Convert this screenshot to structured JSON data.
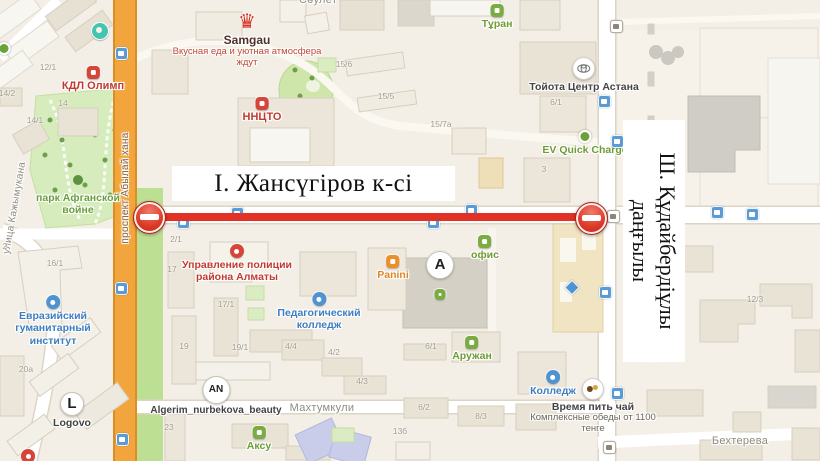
{
  "titles": {
    "horizontal": "І. Жансүгіров к-сі",
    "vertical_line1": "Ш. Құдайбердіұлы",
    "vertical_line2": "даңғылы"
  },
  "colors": {
    "map_bg": "#f3efe7",
    "road_orange": "#f3a53d",
    "park_green": "#d6ecbc",
    "strip_green": "#bcdf93",
    "closure_red": "#e23125",
    "poi_red": "#c13a30",
    "poi_green": "#6d9c33",
    "poi_blue": "#3d7dc0",
    "poi_orange": "#e08427",
    "street_gray": "#8f8b80"
  },
  "labels": [
    {
      "name": "poi-samgau",
      "type": "poi",
      "icon": "crown",
      "icon_size": 20,
      "x": 247,
      "y": 12,
      "text": "Samgau",
      "color": "#503028",
      "size": 12,
      "interactable": true
    },
    {
      "name": "samgau-tagline",
      "type": "tagline",
      "x": 247,
      "y": 46,
      "lines": [
        "Вкусная еда и уютная атмосфера",
        "ждут"
      ],
      "color": "#bf4936",
      "size": 9.5
    },
    {
      "name": "poi-kdl-olimp",
      "type": "poi",
      "icon": "red",
      "x": 93,
      "y": 66,
      "text": "КДЛ Олимп",
      "color": "#c13a30",
      "size": 11,
      "interactable": true
    },
    {
      "name": "poi-nncto",
      "type": "poi",
      "icon": "red",
      "x": 262,
      "y": 97,
      "text": "ННЦТО",
      "color": "#c13a30",
      "size": 11,
      "interactable": true
    },
    {
      "name": "poi-turan",
      "type": "poi",
      "icon": "green",
      "x": 497,
      "y": 4,
      "text": "Тұран",
      "color": "#6d9c33",
      "interactable": true
    },
    {
      "name": "poi-toyota-center",
      "type": "poi",
      "icon": "toyota",
      "icon_size": 21,
      "x": 584,
      "y": 57,
      "text": "Тойота Центр Астана",
      "color": "#454545",
      "interactable": true
    },
    {
      "name": "poi-ev-quick-charge",
      "type": "poi",
      "icon": "ev",
      "x": 585,
      "y": 130,
      "text": "EV Quick Charge",
      "color": "#6d9c33",
      "interactable": true
    },
    {
      "name": "poi-police-department",
      "type": "poi",
      "icon": "redround",
      "x": 237,
      "y": 244,
      "lines": [
        "Управление полиции",
        "района Алматы"
      ],
      "color": "#c13a30",
      "interactable": true
    },
    {
      "name": "poi-eurasian-institute",
      "type": "poi",
      "icon": "blue",
      "x": 53,
      "y": 295,
      "lines": [
        "Евразийский",
        "гуманитарный",
        "институт"
      ],
      "color": "#3d7dc0",
      "interactable": true
    },
    {
      "name": "poi-pedagogical-college",
      "type": "poi",
      "icon": "blue",
      "x": 319,
      "y": 292,
      "lines": [
        "Педагогический",
        "колледж"
      ],
      "color": "#3d7dc0",
      "interactable": true
    },
    {
      "name": "poi-panini",
      "type": "poi",
      "icon": "orange",
      "x": 393,
      "y": 255,
      "text": "Panini",
      "color": "#e08427",
      "interactable": true
    },
    {
      "name": "poi-algerim-beauty",
      "type": "poi",
      "icon": "letter",
      "letter": "AN",
      "icon_size": 26,
      "x": 216,
      "y": 376,
      "text": "Algerim_nurbekova_beauty",
      "color": "#424242",
      "size": 10,
      "interactable": true
    },
    {
      "name": "poi-aruzhan",
      "type": "poi",
      "icon": "green",
      "x": 472,
      "y": 336,
      "text": "Аружан",
      "color": "#6d9c33",
      "interactable": true
    },
    {
      "name": "poi-ofis",
      "type": "poi",
      "icon": "green",
      "x": 485,
      "y": 235,
      "text": "офис",
      "color": "#6d9c33",
      "interactable": true
    },
    {
      "name": "poi-college",
      "type": "poi",
      "icon": "blue",
      "x": 553,
      "y": 370,
      "text": "Колледж",
      "color": "#3d7dc0",
      "interactable": true
    },
    {
      "name": "poi-tea-time",
      "type": "poi",
      "icon": "tea",
      "icon_size": 20,
      "x": 593,
      "y": 378,
      "text": "Время пить чай",
      "color": "#424242",
      "interactable": true
    },
    {
      "name": "tea-time-tagline",
      "type": "tagline",
      "x": 593,
      "y": 412,
      "lines": [
        "Комплексные обеды от 1100",
        "тенге"
      ],
      "color": "#6d655b",
      "size": 9.5
    },
    {
      "name": "poi-aksu",
      "type": "poi",
      "icon": "green",
      "x": 259,
      "y": 426,
      "text": "Аксу",
      "color": "#6d9c33",
      "interactable": true
    },
    {
      "name": "poi-logovo",
      "type": "poi",
      "icon": "letter",
      "letter": "L",
      "icon_size": 22,
      "x": 72,
      "y": 392,
      "text": "Logovo",
      "color": "#424242",
      "interactable": true
    },
    {
      "name": "building-entrance-a",
      "type": "poi",
      "icon": "letter",
      "letter": "A",
      "icon_size": 26,
      "x": 440,
      "y": 251,
      "interactable": true
    },
    {
      "name": "park-label",
      "type": "text",
      "x": 78,
      "y": 192,
      "lines": [
        "парк Афганской",
        "войне"
      ],
      "color": "#6b9e3e",
      "interactable": false
    },
    {
      "name": "street-saulet",
      "type": "street",
      "x": 318,
      "y": -6,
      "text": "Сәулет"
    },
    {
      "name": "street-makhtumkuli",
      "type": "street",
      "x": 322,
      "y": 402,
      "text": "Махтумкули"
    },
    {
      "name": "street-bekhtereva",
      "type": "street",
      "x": 740,
      "y": 435,
      "text": "Бехтерева"
    },
    {
      "name": "street-abylai-khan",
      "type": "street-v",
      "x": 126,
      "y": 188,
      "rot": -90,
      "text": "проспект Абылай хана",
      "color": "#7d6348",
      "size": 10
    },
    {
      "name": "street-kazhymukana",
      "type": "street-v",
      "x": 15,
      "y": 208,
      "rot": -80,
      "text": "улица Кажымукана",
      "size": 10
    },
    {
      "name": "misc-poi-teal-icon",
      "type": "poi",
      "icon": "teal",
      "x": 100,
      "y": 22
    },
    {
      "name": "misc-poi-green-dot",
      "type": "poi",
      "icon": "ev",
      "x": 4,
      "y": 42
    },
    {
      "name": "metro-exit-icon",
      "type": "poi",
      "icon": "diamond",
      "x": 572,
      "y": 282
    },
    {
      "name": "building-poi-green-icon",
      "type": "poi",
      "icon": "green",
      "icon_size": 11,
      "x": 440,
      "y": 289
    },
    {
      "name": "map-pin-bottom-left",
      "type": "poi",
      "icon": "redround",
      "x": 28,
      "y": 449
    }
  ],
  "numbers": [
    {
      "t": "12/1",
      "x": 48,
      "y": 67
    },
    {
      "t": "14/2",
      "x": 7,
      "y": 93
    },
    {
      "t": "14",
      "x": 63,
      "y": 103
    },
    {
      "t": "14/1",
      "x": 35,
      "y": 120
    },
    {
      "t": "2",
      "x": 5,
      "y": 246
    },
    {
      "t": "16/1",
      "x": 55,
      "y": 263
    },
    {
      "t": "20а",
      "x": 26,
      "y": 369
    },
    {
      "t": "2/1",
      "x": 176,
      "y": 239
    },
    {
      "t": "17",
      "x": 172,
      "y": 269
    },
    {
      "t": "17/1",
      "x": 226,
      "y": 304
    },
    {
      "t": "19",
      "x": 184,
      "y": 346
    },
    {
      "t": "19/1",
      "x": 240,
      "y": 347
    },
    {
      "t": "4/4",
      "x": 291,
      "y": 346
    },
    {
      "t": "4/2",
      "x": 334,
      "y": 352
    },
    {
      "t": "4/3",
      "x": 362,
      "y": 381
    },
    {
      "t": "15/6",
      "x": 344,
      "y": 64
    },
    {
      "t": "15/5",
      "x": 386,
      "y": 96
    },
    {
      "t": "15/7а",
      "x": 441,
      "y": 124
    },
    {
      "t": "6/1",
      "x": 556,
      "y": 102
    },
    {
      "t": "3",
      "x": 544,
      "y": 169
    },
    {
      "t": "6/1",
      "x": 431,
      "y": 346
    },
    {
      "t": "6/2",
      "x": 424,
      "y": 407
    },
    {
      "t": "8/3",
      "x": 481,
      "y": 416
    },
    {
      "t": "23",
      "x": 169,
      "y": 427
    },
    {
      "t": "13б",
      "x": 400,
      "y": 431
    },
    {
      "t": "12/3",
      "x": 755,
      "y": 299
    },
    {
      "t": "12/5",
      "x": 654,
      "y": 359
    }
  ],
  "stops": [
    {
      "x": 120,
      "y": 52
    },
    {
      "x": 120,
      "y": 287
    },
    {
      "x": 121,
      "y": 438
    },
    {
      "x": 182,
      "y": 221
    },
    {
      "x": 236,
      "y": 212
    },
    {
      "x": 432,
      "y": 221
    },
    {
      "x": 470,
      "y": 209
    },
    {
      "x": 603,
      "y": 100
    },
    {
      "x": 616,
      "y": 140
    },
    {
      "x": 604,
      "y": 291
    },
    {
      "x": 616,
      "y": 392
    },
    {
      "x": 716,
      "y": 211
    },
    {
      "x": 751,
      "y": 213
    },
    {
      "x": 612,
      "y": 215,
      "v": "w"
    },
    {
      "x": 608,
      "y": 446,
      "v": "w"
    },
    {
      "x": 615,
      "y": 25,
      "v": "w"
    }
  ],
  "closure": {
    "line": {
      "x1": 148,
      "x2": 592,
      "y": 213,
      "thickness": 8
    },
    "signs": [
      {
        "x": 148,
        "y": 216
      },
      {
        "x": 590,
        "y": 217
      }
    ]
  }
}
